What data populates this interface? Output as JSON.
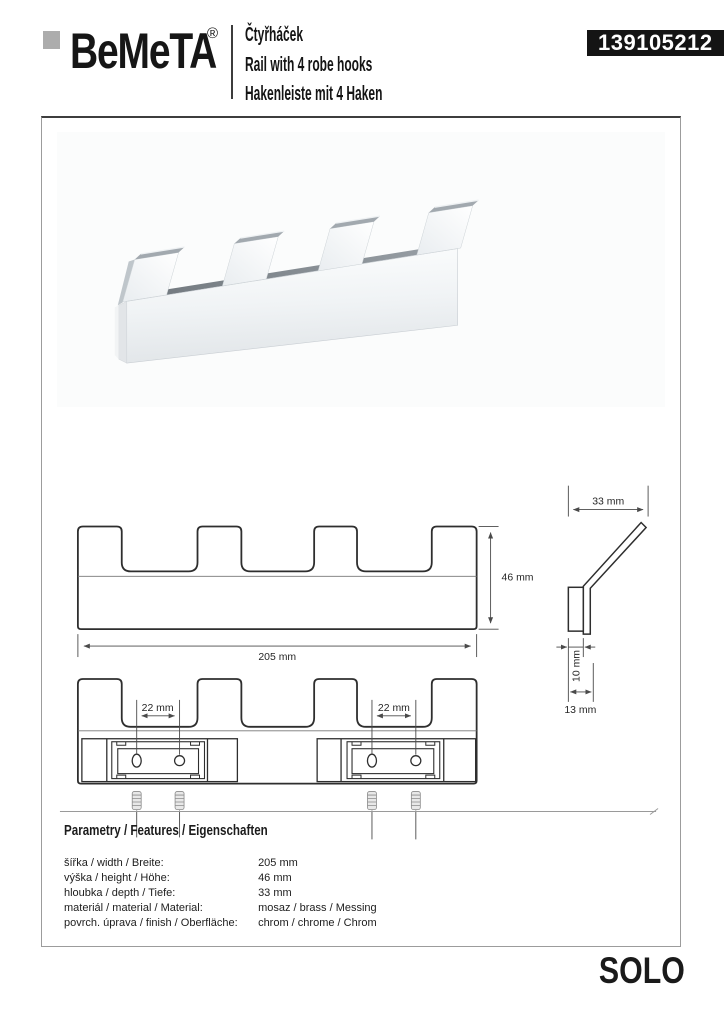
{
  "header": {
    "logo_text": "BeMeTA",
    "logo_reg": "®",
    "product_title_cs": "Čtyřháček",
    "product_title_en": "Rail with 4 robe hooks",
    "product_title_de": "Hakenleiste mit 4 Haken",
    "product_code": "139105212"
  },
  "drawings": {
    "front_view": {
      "width_label": "205 mm",
      "height_label": "46 mm"
    },
    "side_view": {
      "depth_label": "33 mm",
      "plate_depth_label": "10 mm",
      "total_depth_label": "13 mm"
    },
    "mounting_view": {
      "left_hole_spacing_label": "22 mm",
      "right_hole_spacing_label": "22 mm"
    }
  },
  "parameters": {
    "heading": "Parametry / Features / Eigenschaften",
    "rows": [
      {
        "label": "šířka / width / Breite:",
        "value": "205 mm"
      },
      {
        "label": "výška / height / Höhe:",
        "value": "46 mm"
      },
      {
        "label": "hloubka / depth / Tiefe:",
        "value": "33 mm"
      },
      {
        "label": "materiál / material / Material:",
        "value": "mosaz / brass / Messing"
      },
      {
        "label": "povrch. úprava / finish / Oberfläche:",
        "value": "chrom / chrome / Chrom"
      }
    ]
  },
  "footer": {
    "series": "SOLO"
  },
  "colors": {
    "badge_bg": "#141414",
    "badge_text": "#ffffff",
    "logo_square": "#acacac",
    "drawing_outline": "#2e2e2e",
    "dimension_line": "#4a4a4a",
    "chrome_light": "#fdfefe",
    "chrome_dark": "#7c838a"
  }
}
